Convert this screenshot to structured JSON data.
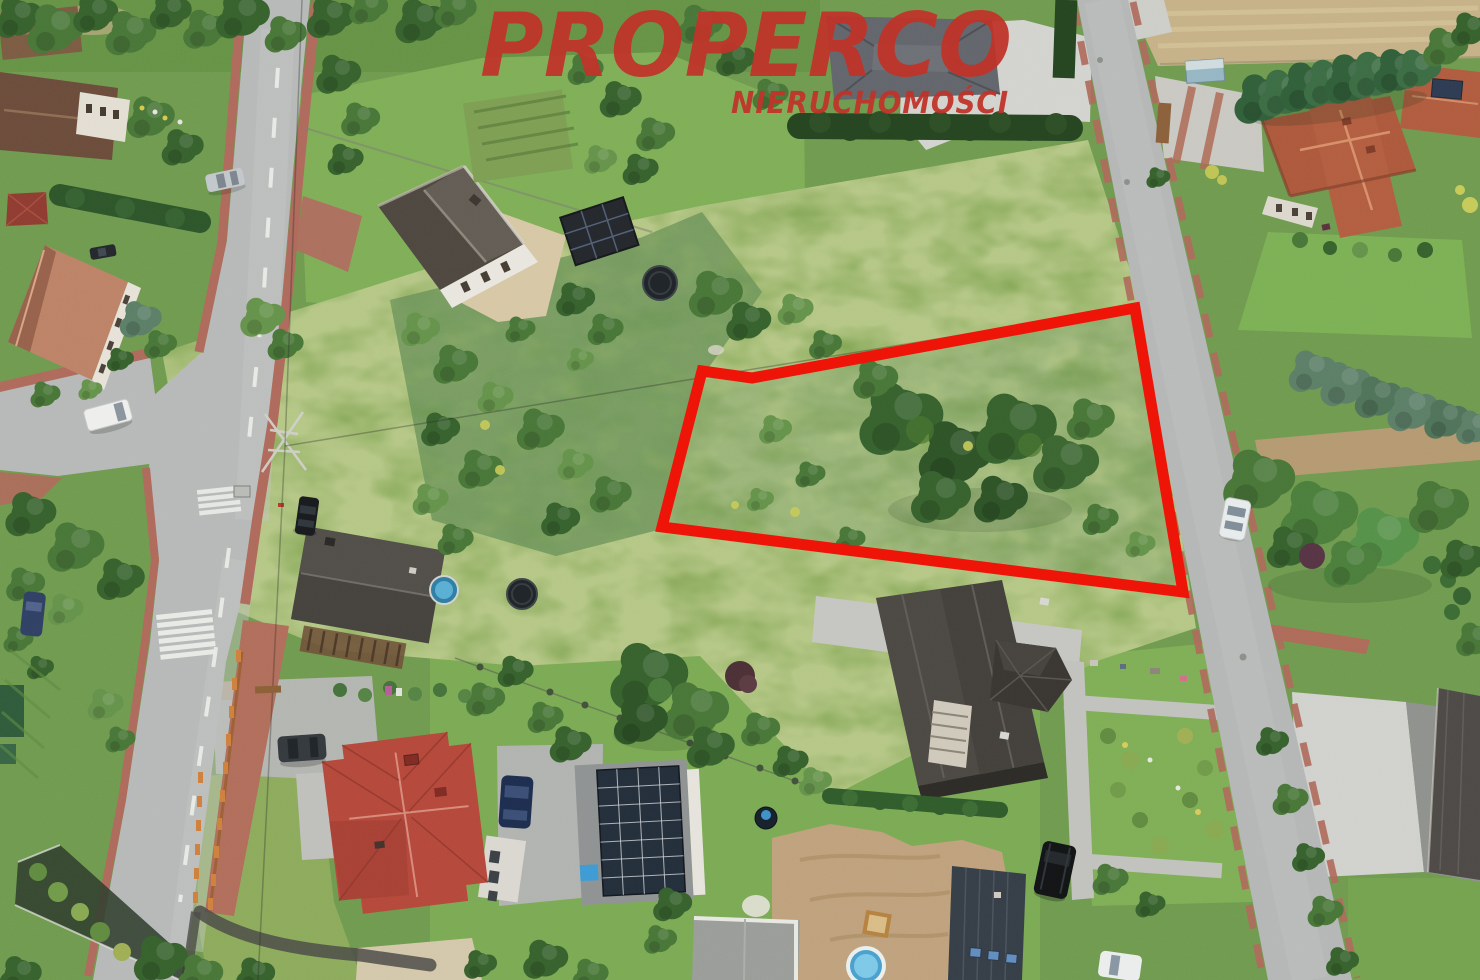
{
  "watermark": {
    "brand": "PROPERCO",
    "tagline": "NIERUCHOMOŚCI",
    "color": "#c0342a"
  },
  "plot_marker": {
    "points": "702,371 752,378 1135,308 1183,592 662,527",
    "stroke": "#ee1408"
  }
}
